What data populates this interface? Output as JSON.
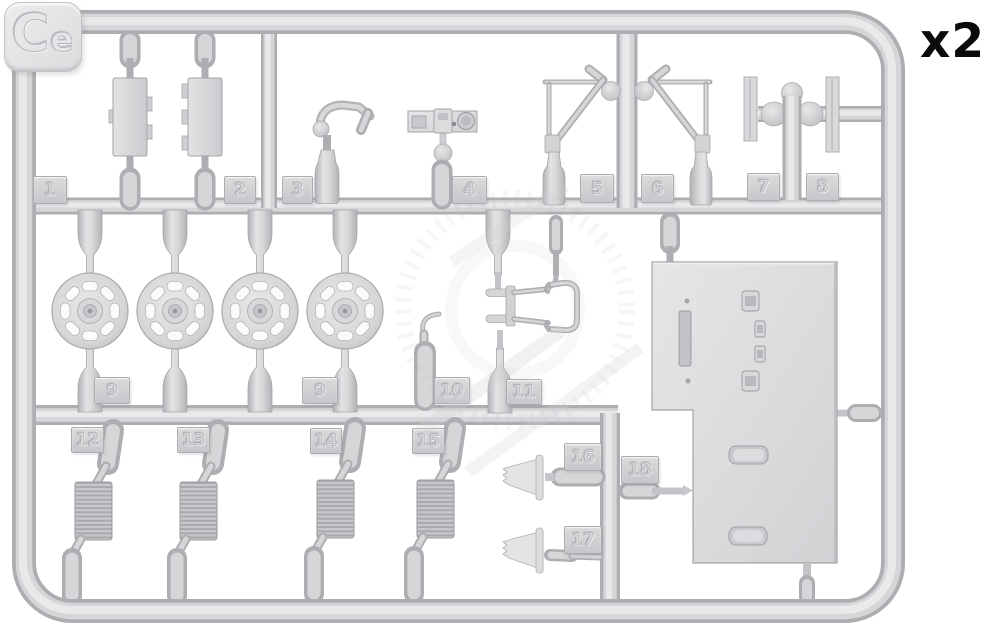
{
  "sprue": {
    "code": "Ce",
    "multiplier": "x2",
    "part_numbers": [
      "1",
      "2",
      "3",
      "4",
      "5",
      "6",
      "7",
      "8",
      "9",
      "9",
      "10",
      "11",
      "12",
      "13",
      "14",
      "15",
      "16",
      "17",
      "18"
    ]
  },
  "colors": {
    "background": "#ffffff",
    "plastic": "#d8d8da",
    "plastic_dark": "#aeaeb2",
    "plastic_light": "#e9e9eb",
    "multiplier_text": "#0b0b0b"
  }
}
